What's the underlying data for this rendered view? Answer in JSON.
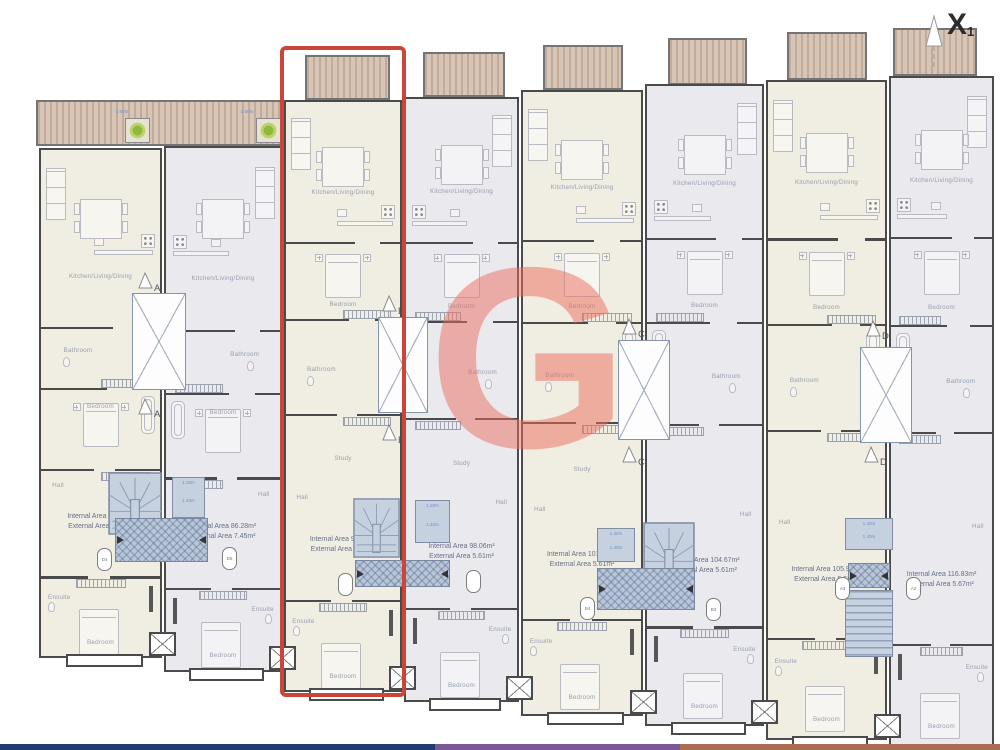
{
  "annotation": {
    "section_flag": "X",
    "section_flag_sub": "1"
  },
  "watermark": {
    "letter": "G"
  },
  "room_labels": {
    "kitchen": "Kitchen/Living/Dining",
    "bedroom": "Bedroom",
    "bathroom": "Bathroom",
    "study": "Study",
    "hall": "Hall",
    "ensuite": "Ensuite"
  },
  "units": [
    {
      "internal_area": "Internal Area 85.59m²",
      "external_area": "External Area 7.45m²",
      "highlighted": false
    },
    {
      "internal_area": "Internal Area 86.28m²",
      "external_area": "External Area 7.45m²",
      "highlighted": false
    },
    {
      "internal_area": "Internal Area 94.68m²",
      "external_area": "External Area 5.61m²",
      "highlighted": true
    },
    {
      "internal_area": "Internal Area 98.06m²",
      "external_area": "External Area 5.61m²",
      "highlighted": false
    },
    {
      "internal_area": "Internal Area 101.46m²",
      "external_area": "External Area 5.61m²",
      "highlighted": false
    },
    {
      "internal_area": "Internal Area 104.67m²",
      "external_area": "External Area 5.61m²",
      "highlighted": false
    },
    {
      "internal_area": "Internal Area 105.91m²",
      "external_area": "External Area 5.62m²",
      "highlighted": false
    },
    {
      "internal_area": "Internal Area 116.83m²",
      "external_area": "External Area 5.67m²",
      "highlighted": false
    }
  ],
  "section_markers": [
    "A",
    "B",
    "C",
    "D"
  ],
  "door_markers": [
    [
      "D4",
      "D5"
    ],
    [
      "",
      ""
    ],
    [
      "B4",
      "B3"
    ],
    [
      "A3",
      "A2"
    ]
  ],
  "dimensions": {
    "planter_width": "1.60m",
    "lightwell_width": "1.20m",
    "lightwell_depth": "1.40m"
  },
  "colors": {
    "highlight": "#cb4639",
    "watermark": "#ec6c5c",
    "deck": "#cdb9ab",
    "stair_fill": "#c3cfdd",
    "floor_cream": "#f0ede2",
    "floor_gray": "#e9e9ee",
    "wall": "#4a4a4a",
    "footer_navy": "#223c72",
    "footer_purple": "#7b5794",
    "footer_brown": "#a96b52"
  }
}
